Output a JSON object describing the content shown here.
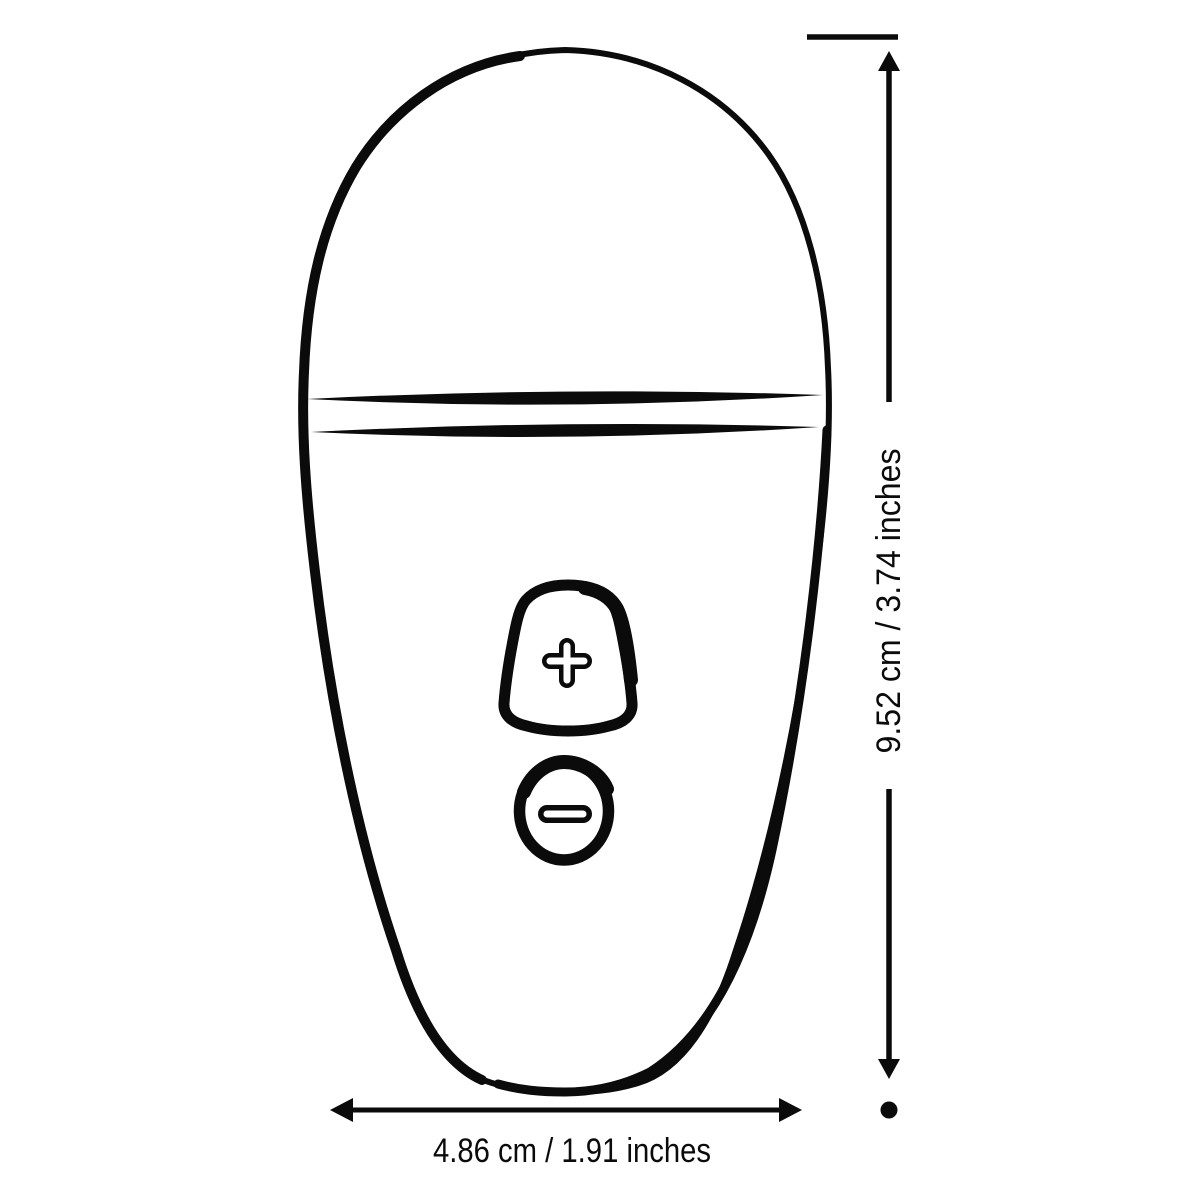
{
  "canvas": {
    "background_color": "#ffffff",
    "line_color": "#0b0b0b"
  },
  "diagram": {
    "description": "product-dimension-line-drawing",
    "device": {
      "buttons": {
        "increase": {
          "icon": "plus-icon"
        },
        "decrease": {
          "icon": "minus-icon"
        }
      }
    },
    "dimensions": {
      "height": {
        "label": "9.52 cm / 3.74 inches",
        "cm": "9.52",
        "inches": "3.74"
      },
      "width": {
        "label": "4.86 cm / 1.91 inches",
        "cm": "4.86",
        "inches": "1.91"
      }
    }
  }
}
